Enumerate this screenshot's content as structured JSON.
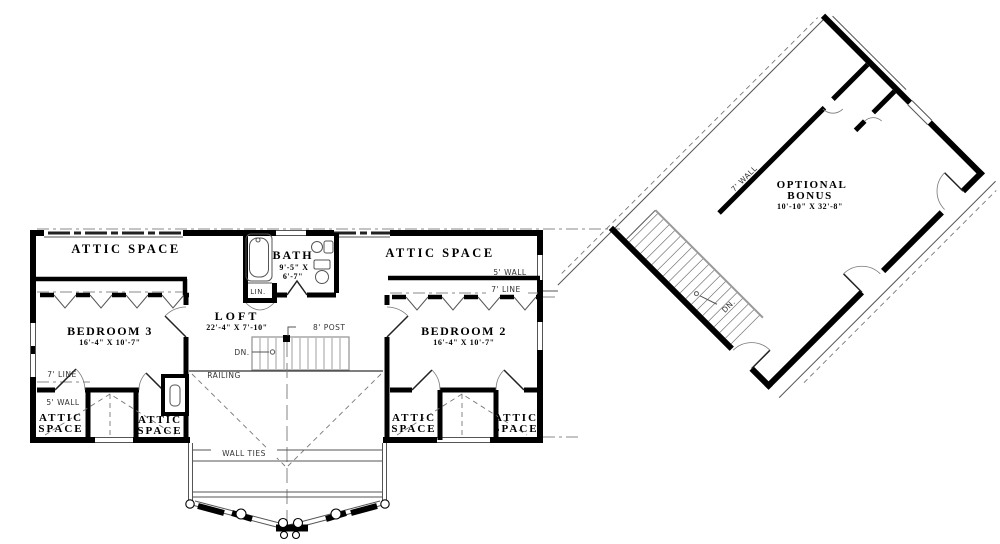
{
  "drawing_type": "second floor plan",
  "rooms": {
    "attic_top_left": {
      "label": "ATTIC SPACE"
    },
    "attic_top_right": {
      "label": "ATTIC SPACE"
    },
    "bath": {
      "label": "BATH",
      "dims1": "9'-5\" X",
      "dims2": "6'-7\""
    },
    "loft": {
      "label": "LOFT",
      "dims": "22'-4\" X 7'-10\""
    },
    "bedroom3": {
      "label": "BEDROOM 3",
      "dims": "16'-4\" X 10'-7\""
    },
    "bedroom2": {
      "label": "BEDROOM 2",
      "dims": "16'-4\" X 10'-7\""
    },
    "attic_bl1": {
      "line1": "ATTIC",
      "line2": "SPACE"
    },
    "attic_bl2": {
      "line1": "ATTIC",
      "line2": "SPACE"
    },
    "attic_br1": {
      "line1": "ATTIC",
      "line2": "SPACE"
    },
    "attic_br2": {
      "line1": "ATTIC",
      "line2": "SPACE"
    },
    "bonus": {
      "line1": "OPTIONAL",
      "line2": "BONUS",
      "dims": "10'-10\" X 32'-8\""
    }
  },
  "annotations": {
    "lin": "LIN.",
    "post": "8' POST",
    "dn_main": "DN.",
    "dn_bonus": "DN.",
    "railing": "RAILING",
    "wall_ties": "WALL TIES",
    "wall5_left": "5' WALL",
    "line7_left": "7' LINE",
    "wall5_right": "5' WALL",
    "line7_right": "7' LINE",
    "wall7_bonus": "7' WALL"
  },
  "colors": {
    "wall": "#000000",
    "thin_line": "#555555",
    "roof_line": "#888888",
    "background": "#ffffff"
  }
}
